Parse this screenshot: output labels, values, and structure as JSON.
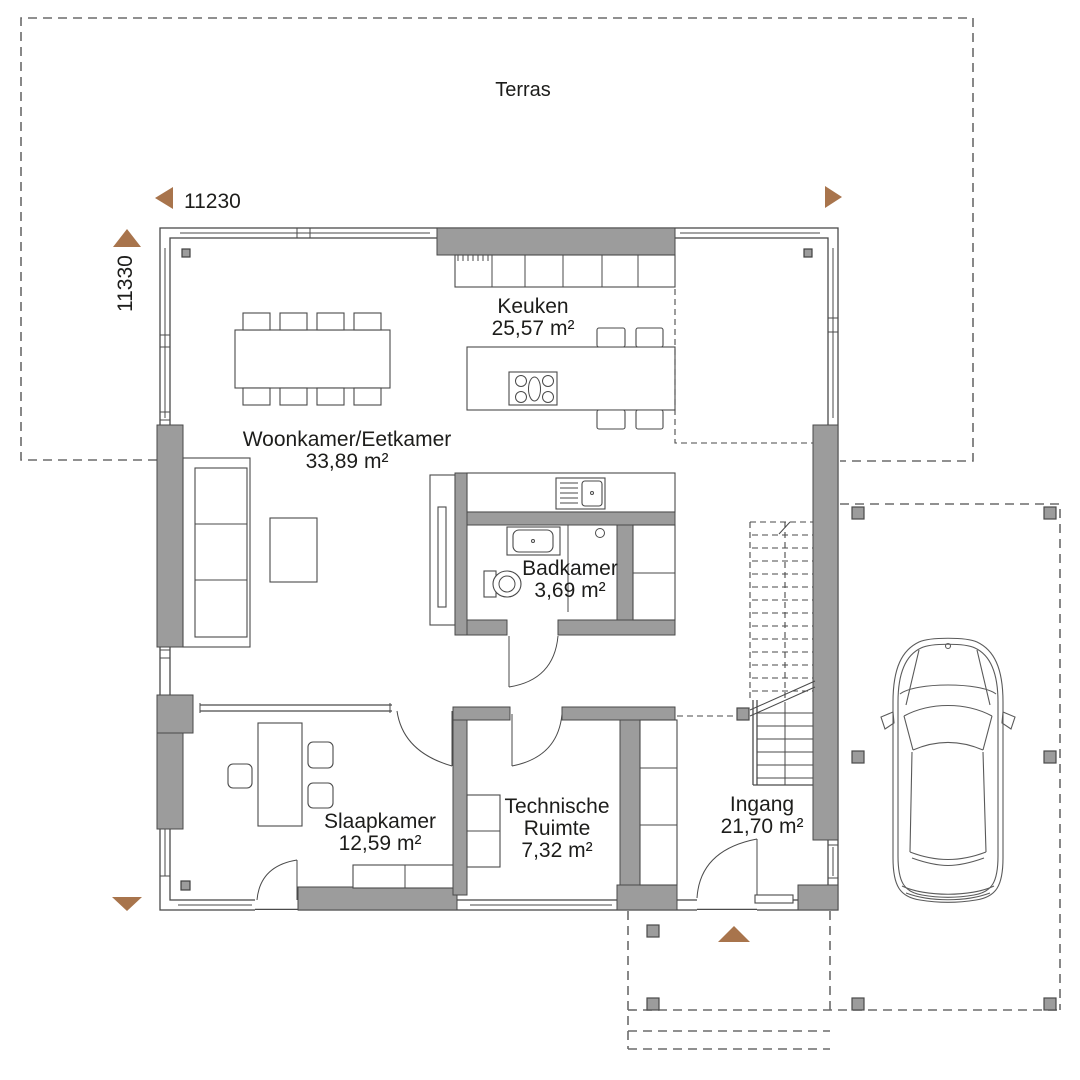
{
  "page": {
    "type": "floor-plan-diagram",
    "language": "nl"
  },
  "colors": {
    "wall": "#9c9c9c",
    "line": "#4a4a4a",
    "dash": "#6b6b6b",
    "accent": "#a8744c",
    "text": "#1d1d1b",
    "background": "#ffffff"
  },
  "dimensions": {
    "width": "11230",
    "height": "11330"
  },
  "areas": {
    "terrace": {
      "label": "Terras"
    }
  },
  "rooms": {
    "keuken": {
      "name": "Keuken",
      "area": "25,57 m²"
    },
    "woonkamer": {
      "name": "Woonkamer/Eetkamer",
      "area": "33,89 m²"
    },
    "badkamer": {
      "name": "Badkamer",
      "area": "3,69 m²"
    },
    "slaapkamer": {
      "name": "Slaapkamer",
      "area": "12,59 m²"
    },
    "technische": {
      "name_line1": "Technische",
      "name_line2": "Ruimte",
      "area": "7,32 m²"
    },
    "ingang": {
      "name": "Ingang",
      "area": "21,70 m²"
    }
  },
  "icons": {
    "dimension_arrow_left": "triangle-left",
    "dimension_arrow_right": "triangle-right",
    "dimension_arrow_up": "triangle-up",
    "dimension_arrow_down": "triangle-down",
    "entrance_marker": "triangle-up"
  }
}
